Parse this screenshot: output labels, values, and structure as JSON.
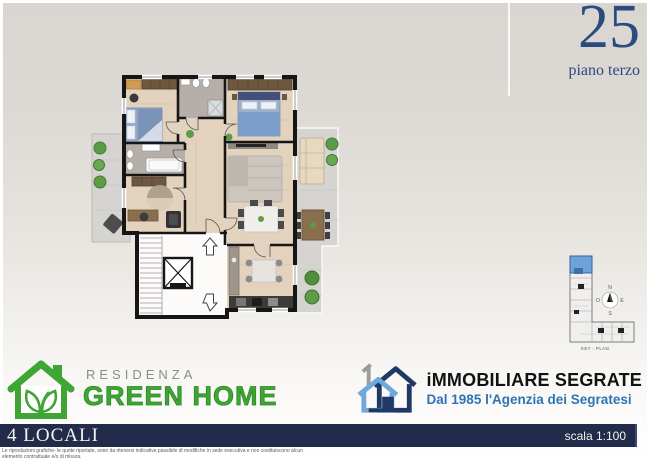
{
  "header": {
    "floor_number": "25",
    "floor_label": "piano terzo"
  },
  "key_plan": {
    "caption": "KEY - PLAN",
    "compass": {
      "n": "N",
      "e": "E",
      "s": "S",
      "o": "O"
    },
    "highlight_color": "#6fa3d8"
  },
  "brand_left": {
    "line1": "RESIDENZA",
    "line2": "GREEN HOME",
    "green": "#3fa535",
    "grey": "#8c8c8c"
  },
  "brand_right": {
    "name": "iMMOBILIARE SEGRATE",
    "tagline": "Dal 1985 l'Agenzia dei Segratesi",
    "navy": "#1f3864",
    "light_blue": "#6fa8dc",
    "blue": "#2e74b5"
  },
  "footer": {
    "unit_type": "4 LOCALI",
    "scale": "scala 1:100",
    "disclaimer_line1": "Le riproduzioni grafiche- le quote riportate, sono da ritenersi indicative passibile di modifiche in sede esecutiva e non costituiscono alcun",
    "disclaimer_line2": "elemento contrattuale e/o di misura."
  },
  "colors": {
    "navy_text": "#2b4a7d",
    "bar_navy": "#222b49",
    "wall_black": "#161616",
    "wood_floor": "#e3d2bd",
    "bath_grey": "#b6afa9",
    "terrace_grey": "#d6d4d0"
  }
}
